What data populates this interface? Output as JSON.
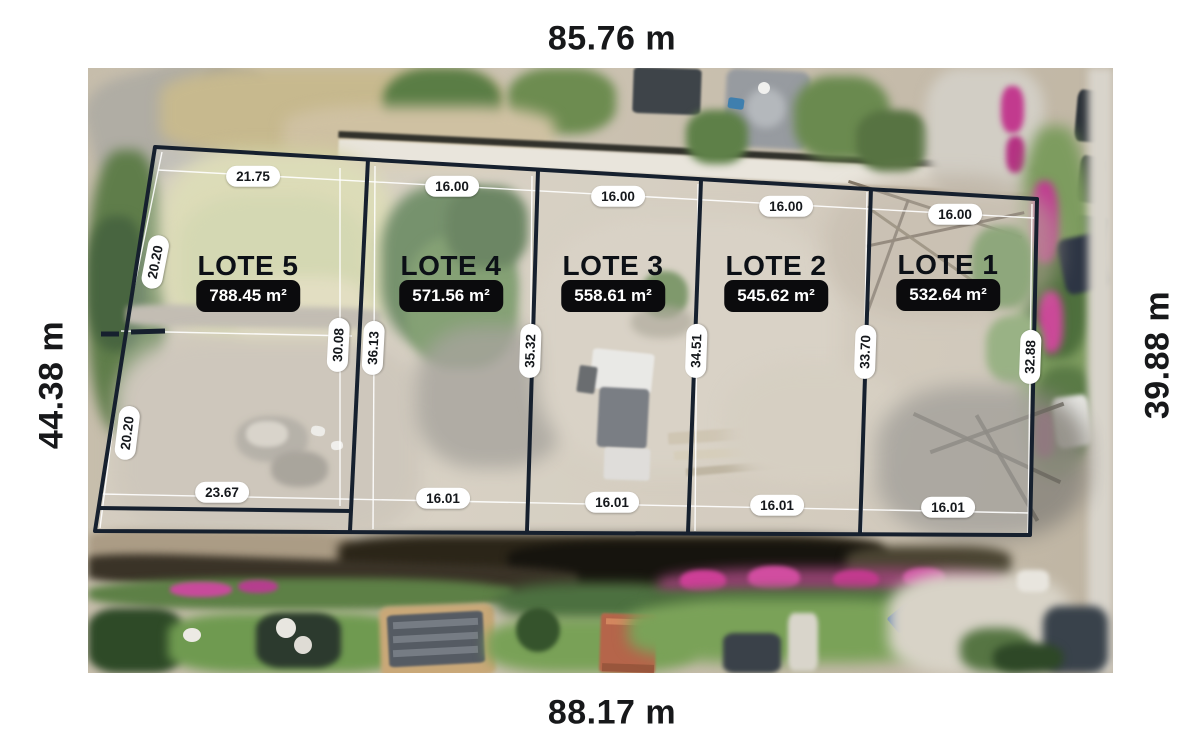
{
  "overall_dimensions": {
    "top": "85.76 m",
    "bottom": "88.17 m",
    "left": "44.38 m",
    "right": "39.88 m"
  },
  "lots": [
    {
      "name": "LOTE 1",
      "area": "532.64 m²"
    },
    {
      "name": "LOTE 2",
      "area": "545.62 m²"
    },
    {
      "name": "LOTE 3",
      "area": "558.61 m²"
    },
    {
      "name": "LOTE 4",
      "area": "571.56 m²"
    },
    {
      "name": "LOTE 5",
      "area": "788.45 m²"
    }
  ],
  "measurements": {
    "top_edges": [
      "21.75",
      "16.00",
      "16.00",
      "16.00",
      "16.00"
    ],
    "bottom_edges": [
      "23.67",
      "16.01",
      "16.01",
      "16.01",
      "16.01"
    ],
    "left_edge_segments": [
      "20.20",
      "20.20"
    ],
    "lot_depths": [
      "30.08",
      "36.13",
      "35.32",
      "34.51",
      "33.70",
      "32.88"
    ]
  },
  "colors": {
    "boundary_line": "#16202e",
    "measurement_line": "#ffffff",
    "pill_bg": "#ffffff",
    "pill_text": "#15181c",
    "area_badge_bg": "#0b0b0d",
    "area_badge_text": "#ffffff",
    "lot_label_text": "#0c1016",
    "dimension_text": "#17181a",
    "canvas_bg": "#ffffff"
  }
}
